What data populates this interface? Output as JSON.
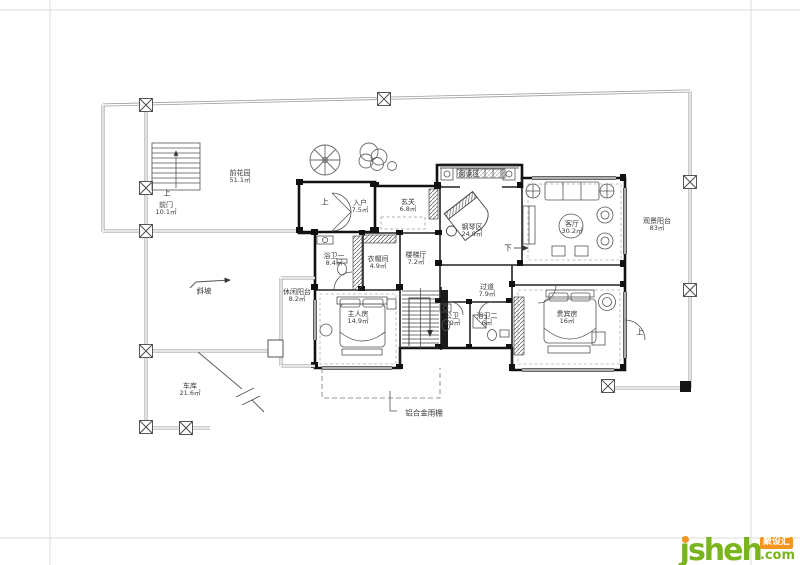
{
  "rooms": {
    "front_garden": {
      "name": "前花园",
      "area": "51.1㎡"
    },
    "front_door": {
      "name": "前门",
      "area": "10.1㎡"
    },
    "entry": {
      "name": "入户",
      "area": "7.5㎡"
    },
    "foyer": {
      "name": "玄关",
      "area": "6.8㎡"
    },
    "reading_area": {
      "name": "阅读区",
      "area": ""
    },
    "piano_area": {
      "name": "钢琴区",
      "area": "24.9㎡"
    },
    "living_room": {
      "name": "客厅",
      "area": "30.2㎡"
    },
    "view_balcony": {
      "name": "观景阳台",
      "area": "83㎡"
    },
    "bath_1": {
      "name": "浴卫一",
      "area": "8.4㎡"
    },
    "cloakroom": {
      "name": "衣帽间",
      "area": "4.9㎡"
    },
    "stair_hall": {
      "name": "楼梯厅",
      "area": "7.2㎡"
    },
    "corridor": {
      "name": "过道",
      "area": "7.9㎡"
    },
    "public_bath": {
      "name": "公卫",
      "area": "4.9㎡"
    },
    "bath_2": {
      "name": "浴卫二",
      "area": "6㎡"
    },
    "master_bedroom": {
      "name": "主人房",
      "area": "14.9㎡"
    },
    "leisure_balcony": {
      "name": "休闲阳台",
      "area": "8.2㎡"
    },
    "vip_room": {
      "name": "贵宾房",
      "area": "16㎡"
    },
    "garage": {
      "name": "车库",
      "area": "21.6㎡"
    }
  },
  "annotations": {
    "up": "上",
    "down": "下",
    "slope": "斜坡",
    "canopy": "铝合金雨棚"
  },
  "watermark": {
    "brand": "jsheh",
    "tld": ".com",
    "badge": "聚设汇",
    "green": "#7ab51d",
    "orange": "#f7941e"
  }
}
